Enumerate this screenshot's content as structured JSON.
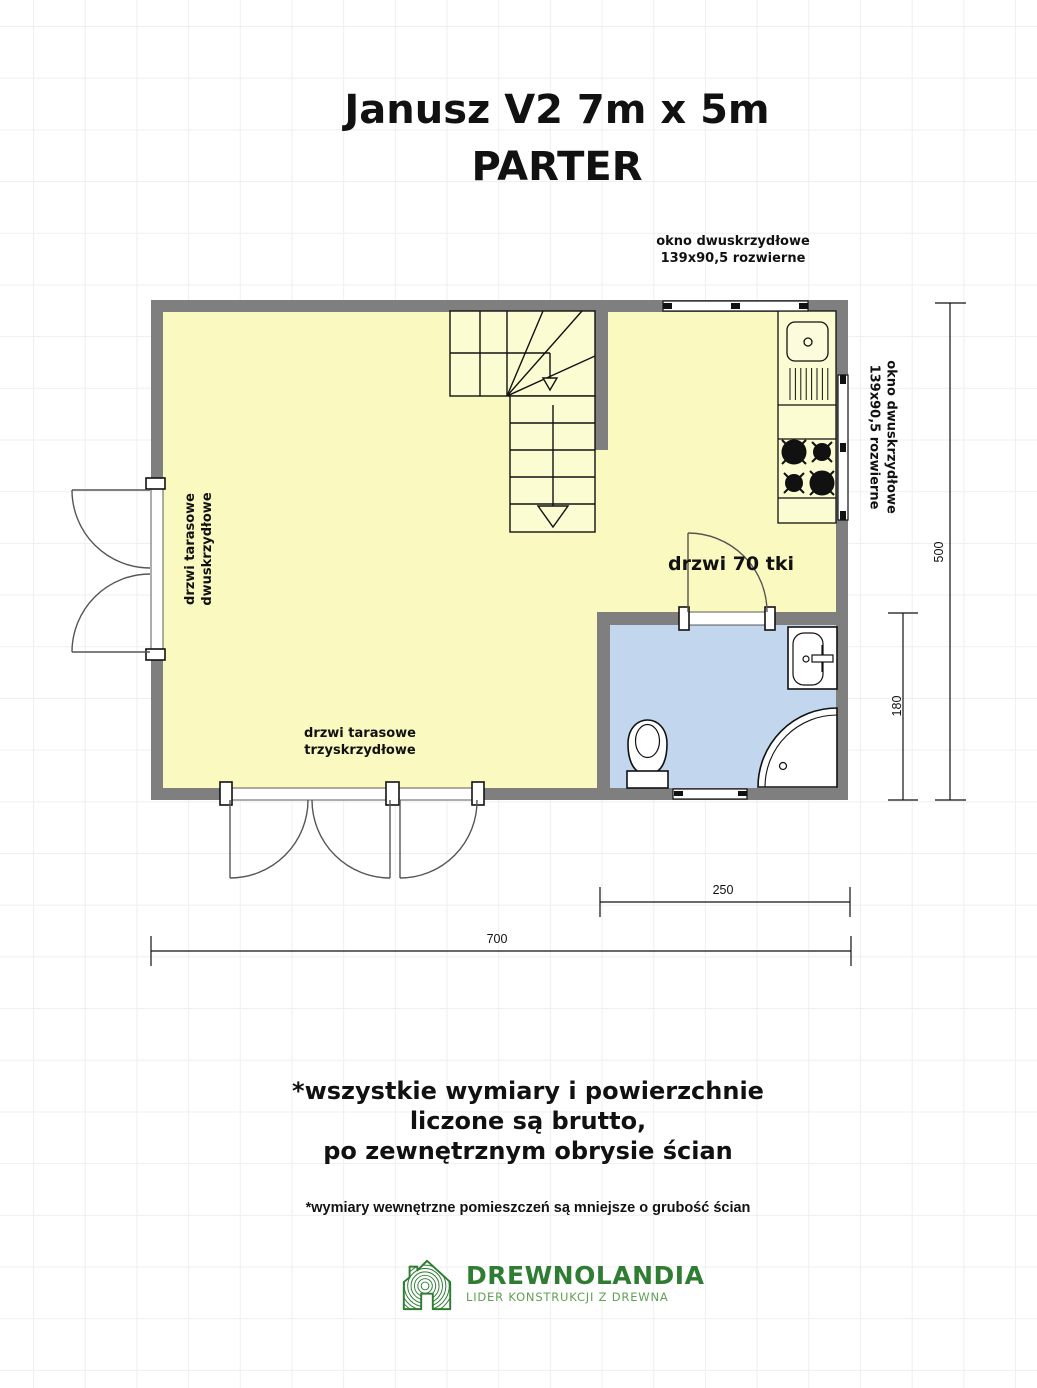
{
  "title": {
    "line1": "Janusz V2 7m x 5m",
    "line2": "PARTER"
  },
  "plan": {
    "labels": {
      "window_top": [
        "okno dwuskrzydłowe",
        "139x90,5 rozwierne"
      ],
      "window_right": [
        "okno dwuskrzydłowe",
        "139x90,5 rozwierne"
      ],
      "terrace_door_left": [
        "drzwi tarasowe",
        "dwuskrzydłowe"
      ],
      "terrace_door_bottom": [
        "drzwi tarasowe",
        "trzyskrzydłowe"
      ],
      "bathroom_door": "drzwi 70 tki"
    },
    "dimensions": {
      "total_width": "700",
      "total_height": "500",
      "bathroom_width": "250",
      "bathroom_height": "180"
    },
    "colors": {
      "wall_gray": "#7f7f7f",
      "room_yellow": "#f9f9c0",
      "bathroom_blue": "#c2d7ee",
      "line_black": "#111111"
    }
  },
  "notes": {
    "main_line1": "*wszystkie wymiary i powierzchnie",
    "main_line2": "liczone są brutto,",
    "main_line3": "po zewnętrznym obrysie ścian",
    "secondary": "*wymiary wewnętrzne pomieszczeń są mniejsze o grubość ścian"
  },
  "logo": {
    "name": "DREWNOLANDIA",
    "tagline": "LIDER KONSTRUKCJI Z DREWNA",
    "color_dark_green": "#2e7d32",
    "color_light_green": "#5fa052"
  }
}
